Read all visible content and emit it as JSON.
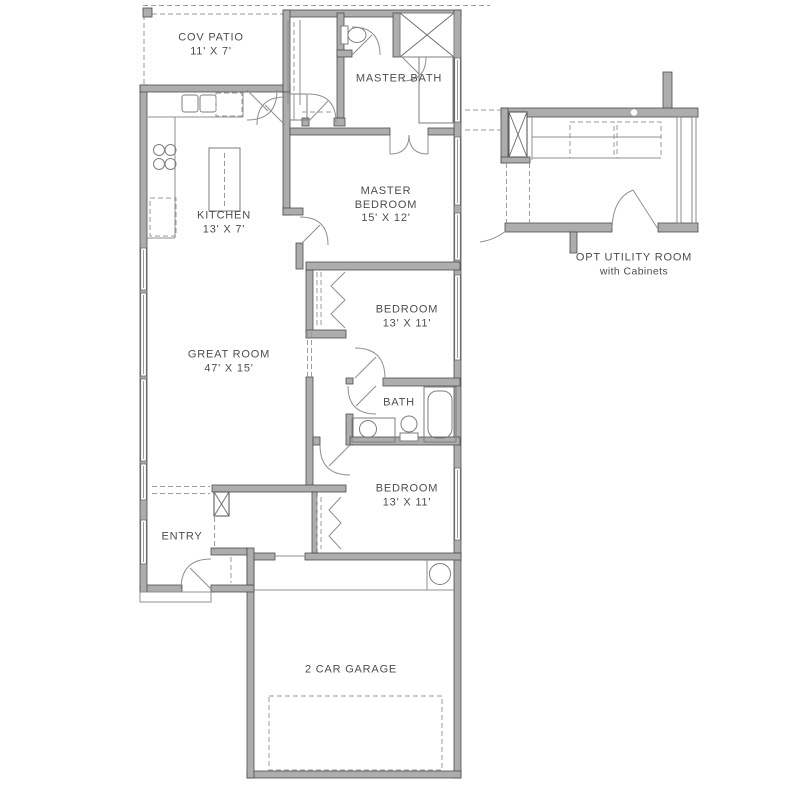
{
  "plan": {
    "type": "single-story house floor plan",
    "colors": {
      "background": "#ffffff",
      "wall_fill": "#adadad",
      "wall_edge": "#4c4c4c",
      "thin_line": "#8f8f8f",
      "text": "#4d4d4d"
    },
    "rooms": {
      "cov_patio": {
        "name": "COV PATIO",
        "dims": "11' X 7'"
      },
      "master_bath": {
        "name": "MASTER BATH"
      },
      "kitchen": {
        "name": "KITCHEN",
        "dims": "13' X 7'"
      },
      "master_bedroom": {
        "name": "MASTER BEDROOM",
        "dims": "15' X 12'"
      },
      "great_room": {
        "name": "GREAT ROOM",
        "dims": "47' X 15'"
      },
      "bedroom_mid": {
        "name": "BEDROOM",
        "dims": "13' X 11'"
      },
      "bath": {
        "name": "BATH"
      },
      "bedroom_lower": {
        "name": "BEDROOM",
        "dims": "13' X 11'"
      },
      "entry": {
        "name": "ENTRY"
      },
      "garage": {
        "name": "2 CAR GARAGE"
      },
      "opt_utility": {
        "name": "OPT UTILITY ROOM",
        "sub": "with Cabinets"
      }
    },
    "fixtures": [
      "kitchen-sink",
      "dishwasher",
      "range",
      "refrigerator",
      "kitchen-island",
      "toilet",
      "shower",
      "master-vanity",
      "tub",
      "hall-vanity-sink",
      "water-heater",
      "linen-closet",
      "utility-cabinets"
    ]
  }
}
